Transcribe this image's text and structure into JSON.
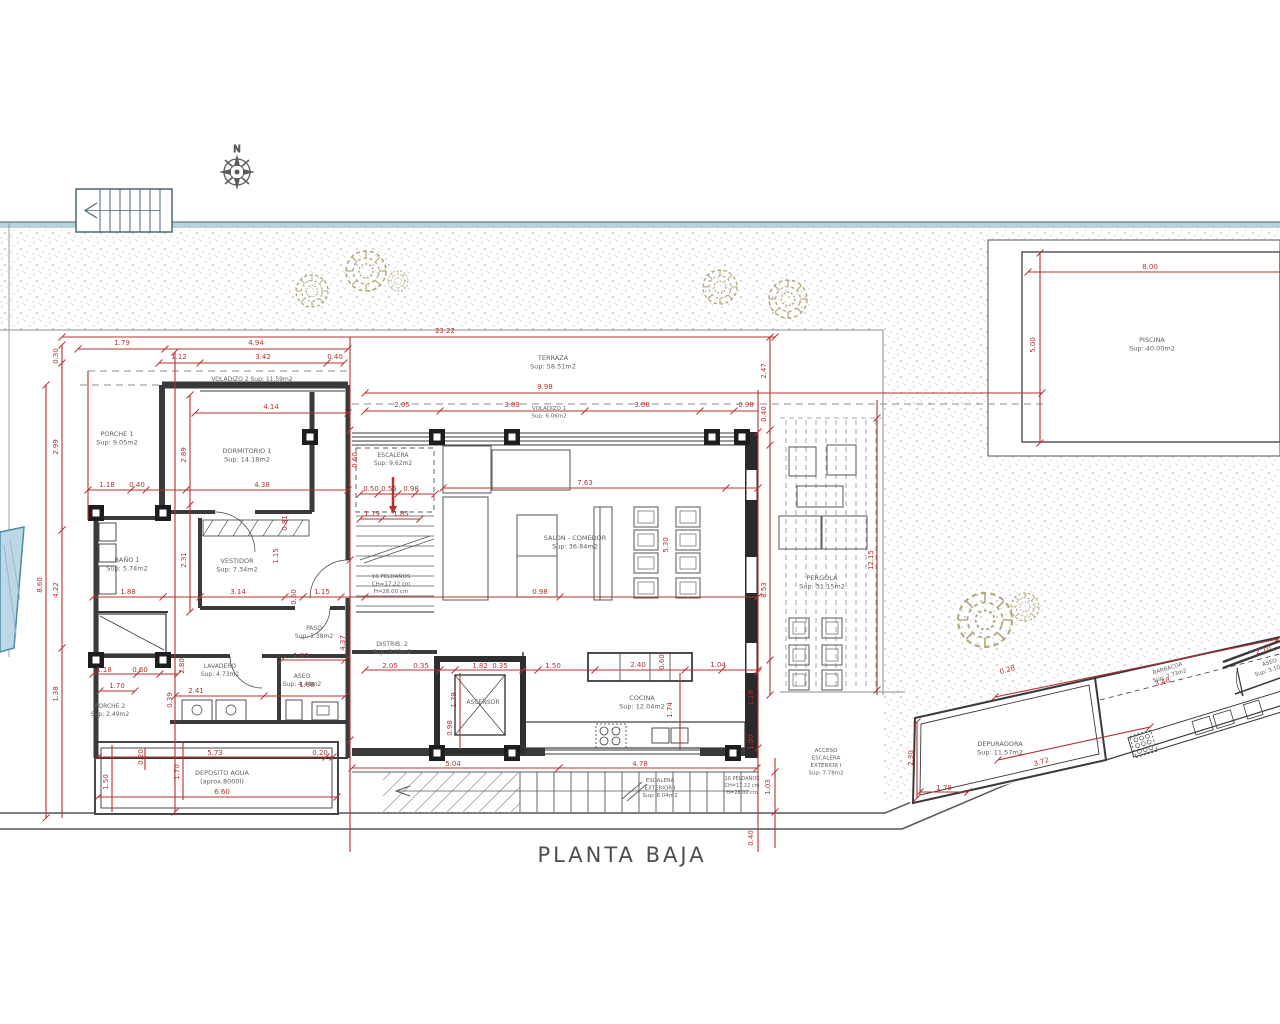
{
  "title": "PLANTA BAJA",
  "compass": "N",
  "colors": {
    "dimension_red": "#b5312f",
    "wall_dark": "#3a3a3c",
    "thin_line": "#6f7377",
    "stipple_gray": "#8e959b",
    "tree_tan": "#b3a87c",
    "water_blue": "#bcd8e6",
    "band_teal": "#b7d2da",
    "label_gray": "#5f5f5f"
  },
  "labels": [
    {
      "lines": [
        "PORCHE 1",
        "Sup: 9.05m2"
      ],
      "x": 117,
      "y": 436,
      "fs": 6.5
    },
    {
      "lines": [
        "VOLADIZO 2  Sup: 11.59m2"
      ],
      "x": 252,
      "y": 381,
      "fs": 6
    },
    {
      "lines": [
        "DORMITORIO 1",
        "Sup: 14.18m2"
      ],
      "x": 247,
      "y": 453,
      "fs": 6.5
    },
    {
      "lines": [
        "BAÑO 1",
        "Sup: 5.74m2"
      ],
      "x": 127,
      "y": 562,
      "fs": 6.5
    },
    {
      "lines": [
        "VESTIDOR",
        "Sup: 7.34m2"
      ],
      "x": 237,
      "y": 563,
      "fs": 6.5
    },
    {
      "lines": [
        "PASO",
        "Sup: 1.38m2"
      ],
      "x": 314,
      "y": 630,
      "fs": 6
    },
    {
      "lines": [
        "LAVADERO",
        "Sup: 4.73m2"
      ],
      "x": 220,
      "y": 668,
      "fs": 6
    },
    {
      "lines": [
        "ASEO",
        "Sup: 4.44m2"
      ],
      "x": 302,
      "y": 678,
      "fs": 6
    },
    {
      "lines": [
        "PORCHE 2",
        "Sup: 2.49m2"
      ],
      "x": 110,
      "y": 708,
      "fs": 6
    },
    {
      "lines": [
        "ESCALERA",
        "Sup: 9.62m2"
      ],
      "x": 393,
      "y": 457,
      "fs": 6
    },
    {
      "lines": [
        "DISTRIB. 2",
        "Sup: 3.13m2"
      ],
      "x": 392,
      "y": 646,
      "fs": 6
    },
    {
      "lines": [
        "ASCENSOR"
      ],
      "x": 483,
      "y": 704,
      "fs": 6
    },
    {
      "lines": [
        "SALON - COMEDOR",
        "Sup: 36.84m2"
      ],
      "x": 575,
      "y": 540,
      "fs": 6.5
    },
    {
      "lines": [
        "COCINA",
        "Sup: 12.04m2"
      ],
      "x": 642,
      "y": 700,
      "fs": 6.5
    },
    {
      "lines": [
        "TERRAZA",
        "Sup: 58.51m2"
      ],
      "x": 553,
      "y": 360,
      "fs": 6.5
    },
    {
      "lines": [
        "VOLADIZO 1",
        "Sup: 6.06m2"
      ],
      "x": 549,
      "y": 410,
      "fs": 5.5
    },
    {
      "lines": [
        "PERGOLA",
        "Sup: 31.15m2"
      ],
      "x": 822,
      "y": 580,
      "fs": 6.5
    },
    {
      "lines": [
        "PISCINA",
        "Sup: 40.00m2"
      ],
      "x": 1152,
      "y": 342,
      "fs": 6.5
    },
    {
      "lines": [
        "DEPOSITO AGUA",
        "(aprox.8000l)"
      ],
      "x": 222,
      "y": 775,
      "fs": 6.5
    },
    {
      "lines": [
        "ESCALERA",
        "EXTERIOR I",
        "Sup: 8.04m2"
      ],
      "x": 660,
      "y": 782,
      "fs": 5.5
    },
    {
      "lines": [
        "16 PELDAÑOS",
        "CH=17.22 cm",
        "H=28.00 cm"
      ],
      "x": 391,
      "y": 578,
      "fs": 5.5
    },
    {
      "lines": [
        "16 PELDAÑOS",
        "CH=17.22 cm",
        "H=28.00 cm"
      ],
      "x": 742,
      "y": 780,
      "fs": 5
    },
    {
      "lines": [
        "ACCESO",
        "ESCALERA",
        "EXTERIOR I",
        "Sup: 7.78m2"
      ],
      "x": 826,
      "y": 752,
      "fs": 5.5
    },
    {
      "lines": [
        "DEPURADORA",
        "Sup: 11.57m2"
      ],
      "x": 1000,
      "y": 746,
      "fs": 6.5
    },
    {
      "lines": [
        "BARBACOA",
        "Sup: 7.73m2"
      ],
      "x": 1168,
      "y": 670,
      "fs": 5.5,
      "r": -17
    },
    {
      "lines": [
        "ASEO",
        "Sup: 3.10m2"
      ],
      "x": 1270,
      "y": 664,
      "fs": 5.5,
      "r": -17
    }
  ],
  "dims": [
    {
      "t": "23.22",
      "x": 445,
      "y": 333
    },
    {
      "t": "1.79",
      "x": 122,
      "y": 345
    },
    {
      "t": "4.94",
      "x": 256,
      "y": 345
    },
    {
      "t": "1.12",
      "x": 179,
      "y": 359
    },
    {
      "t": "3.42",
      "x": 263,
      "y": 359
    },
    {
      "t": "0.40",
      "x": 335,
      "y": 359
    },
    {
      "t": "4.14",
      "x": 271,
      "y": 409
    },
    {
      "t": "9.98",
      "x": 545,
      "y": 389
    },
    {
      "t": "2.05",
      "x": 402,
      "y": 407
    },
    {
      "t": "3.89",
      "x": 512,
      "y": 407
    },
    {
      "t": "3.08",
      "x": 642,
      "y": 407
    },
    {
      "t": "0.98",
      "x": 746,
      "y": 407
    },
    {
      "t": "7.63",
      "x": 585,
      "y": 485
    },
    {
      "t": "5.30",
      "x": 668,
      "y": 545,
      "r": -90
    },
    {
      "t": "0.98",
      "x": 540,
      "y": 594
    },
    {
      "t": "2.47",
      "x": 766,
      "y": 371,
      "r": -90
    },
    {
      "t": "0.40",
      "x": 766,
      "y": 414,
      "r": -90
    },
    {
      "t": "8.53",
      "x": 766,
      "y": 590,
      "r": -90
    },
    {
      "t": "12.15",
      "x": 873,
      "y": 560,
      "r": -90
    },
    {
      "t": "0.30",
      "x": 58,
      "y": 356,
      "r": -90
    },
    {
      "t": "2.99",
      "x": 58,
      "y": 447,
      "r": -90
    },
    {
      "t": "4.22",
      "x": 58,
      "y": 590,
      "r": -90
    },
    {
      "t": "8.60",
      "x": 42,
      "y": 585,
      "r": -90
    },
    {
      "t": "2.89",
      "x": 186,
      "y": 455,
      "r": -90
    },
    {
      "t": "2.31",
      "x": 186,
      "y": 560,
      "r": -90
    },
    {
      "t": "1.18",
      "x": 107,
      "y": 487
    },
    {
      "t": "0.40",
      "x": 137,
      "y": 487
    },
    {
      "t": "4.38",
      "x": 262,
      "y": 487
    },
    {
      "t": "0.81",
      "x": 287,
      "y": 523,
      "r": -90
    },
    {
      "t": "1.15",
      "x": 278,
      "y": 556,
      "r": -90
    },
    {
      "t": "3.14",
      "x": 238,
      "y": 594
    },
    {
      "t": "1.88",
      "x": 128,
      "y": 594
    },
    {
      "t": "0.60",
      "x": 296,
      "y": 597,
      "r": -90
    },
    {
      "t": "1.15",
      "x": 322,
      "y": 594
    },
    {
      "t": "0.60",
      "x": 357,
      "y": 460,
      "r": -90
    },
    {
      "t": "0.50",
      "x": 371,
      "y": 491
    },
    {
      "t": "0.55",
      "x": 389,
      "y": 491
    },
    {
      "t": "0.98",
      "x": 411,
      "y": 491
    },
    {
      "t": "1.19",
      "x": 372,
      "y": 516
    },
    {
      "t": "1.85",
      "x": 401,
      "y": 516
    },
    {
      "t": "4.37",
      "x": 345,
      "y": 643,
      "r": -90
    },
    {
      "t": "1.83",
      "x": 301,
      "y": 658
    },
    {
      "t": "2.41",
      "x": 196,
      "y": 693
    },
    {
      "t": "1.88",
      "x": 307,
      "y": 687
    },
    {
      "t": "1.18",
      "x": 104,
      "y": 672
    },
    {
      "t": "0.60",
      "x": 140,
      "y": 672
    },
    {
      "t": "1.70",
      "x": 117,
      "y": 688
    },
    {
      "t": "1.38",
      "x": 58,
      "y": 694,
      "r": -90
    },
    {
      "t": "2.80",
      "x": 184,
      "y": 666,
      "r": -90
    },
    {
      "t": "0.39",
      "x": 172,
      "y": 700,
      "r": -90
    },
    {
      "t": "2.05",
      "x": 390,
      "y": 668
    },
    {
      "t": "0.35",
      "x": 421,
      "y": 668
    },
    {
      "t": "1.82",
      "x": 480,
      "y": 668
    },
    {
      "t": "0.35",
      "x": 500,
      "y": 668
    },
    {
      "t": "1.50",
      "x": 553,
      "y": 668
    },
    {
      "t": "2.40",
      "x": 638,
      "y": 667
    },
    {
      "t": "1.04",
      "x": 718,
      "y": 667
    },
    {
      "t": "0.60",
      "x": 664,
      "y": 662,
      "r": -90
    },
    {
      "t": "1.79",
      "x": 456,
      "y": 700,
      "r": -90
    },
    {
      "t": "1.74",
      "x": 672,
      "y": 710,
      "r": -90
    },
    {
      "t": "0.98",
      "x": 452,
      "y": 728,
      "r": -90
    },
    {
      "t": "1.19",
      "x": 753,
      "y": 698,
      "r": -90
    },
    {
      "t": "1.00",
      "x": 753,
      "y": 742,
      "r": -90
    },
    {
      "t": "5.04",
      "x": 453,
      "y": 766
    },
    {
      "t": "4.78",
      "x": 640,
      "y": 766
    },
    {
      "t": "1.03",
      "x": 770,
      "y": 787,
      "r": -90
    },
    {
      "t": "0.40",
      "x": 753,
      "y": 838,
      "r": -90
    },
    {
      "t": "5.73",
      "x": 215,
      "y": 755
    },
    {
      "t": "0.20",
      "x": 320,
      "y": 755
    },
    {
      "t": "6.60",
      "x": 222,
      "y": 794
    },
    {
      "t": "1.50",
      "x": 108,
      "y": 782,
      "r": -90
    },
    {
      "t": "1.70",
      "x": 179,
      "y": 772,
      "r": -90
    },
    {
      "t": "0.20",
      "x": 143,
      "y": 757,
      "r": -90
    },
    {
      "t": "8.00",
      "x": 1150,
      "y": 269
    },
    {
      "t": "5.00",
      "x": 1035,
      "y": 345,
      "r": -90
    },
    {
      "t": "2.30",
      "x": 913,
      "y": 758,
      "r": -90
    },
    {
      "t": "3.72",
      "x": 1042,
      "y": 764,
      "r": -17
    },
    {
      "t": "1.78",
      "x": 944,
      "y": 790
    },
    {
      "t": "3.48",
      "x": 1163,
      "y": 684,
      "r": -17
    },
    {
      "t": "2.10",
      "x": 1264,
      "y": 652,
      "r": -17
    },
    {
      "t": "0.28",
      "x": 1008,
      "y": 672,
      "r": -17
    }
  ],
  "dim_lines": {
    "h": [
      [
        337,
        62,
        775,
        [
          62,
          775
        ]
      ],
      [
        349,
        78,
        348,
        [
          78,
          165,
          348
        ]
      ],
      [
        363,
        159,
        344,
        [
          159,
          200,
          327,
          344
        ]
      ],
      [
        413,
        195,
        348,
        [
          195,
          348
        ]
      ],
      [
        393,
        365,
        1042,
        [
          365,
          1042
        ]
      ],
      [
        411,
        365,
        758,
        [
          365,
          440,
          585,
          700,
          734
        ]
      ],
      [
        488,
        443,
        758,
        [
          443,
          726,
          758
        ]
      ],
      [
        490,
        88,
        348,
        [
          88,
          131,
          146,
          186,
          348
        ]
      ],
      [
        597,
        93,
        758,
        [
          93,
          163,
          200,
          285,
          303,
          341,
          365,
          560,
          758
        ]
      ],
      [
        519,
        360,
        420,
        [
          360,
          382,
          420
        ]
      ],
      [
        494,
        360,
        435,
        [
          360,
          378,
          398,
          415,
          435
        ]
      ],
      [
        660,
        282,
        345,
        [
          282,
          345
        ]
      ],
      [
        674,
        93,
        178,
        [
          93,
          137,
          160,
          178
        ]
      ],
      [
        670,
        365,
        758,
        [
          365,
          440,
          455,
          523,
          538,
          595,
          685,
          722,
          758
        ]
      ],
      [
        691,
        100,
        135,
        [
          100,
          135
        ]
      ],
      [
        696,
        175,
        345,
        [
          175,
          264,
          345
        ]
      ],
      [
        768,
        352,
        757,
        [
          352,
          559,
          757
        ]
      ],
      [
        757,
        98,
        333,
        [
          98,
          326,
          333
        ]
      ],
      [
        797,
        98,
        337,
        [
          98,
          337
        ]
      ],
      [
        272,
        1028,
        1280,
        [
          1028
        ]
      ],
      [
        792,
        920,
        968,
        [
          920,
          968
        ]
      ]
    ],
    "v": [
      [
        62,
        345,
        818,
        [
          345,
          363,
          530,
          648
        ]
      ],
      [
        46,
        385,
        818,
        [
          385,
          818
        ]
      ],
      [
        88,
        371,
        520,
        []
      ],
      [
        175,
        352,
        812,
        [
          352,
          812
        ]
      ],
      [
        190,
        395,
        612,
        [
          395,
          505,
          612
        ]
      ],
      [
        350,
        337,
        852,
        [
          430,
          560,
          740
        ]
      ],
      [
        758,
        390,
        852,
        [
          432,
          672,
          748
        ]
      ],
      [
        770,
        337,
        695,
        [
          337,
          430,
          445,
          660,
          695
        ]
      ],
      [
        877,
        400,
        695,
        [
          418,
          690
        ]
      ],
      [
        775,
        758,
        848,
        [
          772,
          812
        ]
      ],
      [
        1040,
        253,
        443,
        [
          253,
          443
        ]
      ],
      [
        112,
        745,
        812,
        []
      ],
      [
        183,
        743,
        800,
        []
      ],
      [
        917,
        722,
        798,
        [
          722,
          798
        ]
      ],
      [
        680,
        673,
        750,
        []
      ],
      [
        460,
        673,
        750,
        []
      ],
      [
        145,
        748,
        770,
        []
      ]
    ],
    "s": [
      [
        995,
        697,
        1278,
        639
      ],
      [
        998,
        760,
        1150,
        727
      ]
    ]
  },
  "trees": [
    {
      "x": 312,
      "y": 291,
      "s": 0.8
    },
    {
      "x": 366,
      "y": 271,
      "s": 1.0
    },
    {
      "x": 398,
      "y": 281,
      "s": 0.5
    },
    {
      "x": 720,
      "y": 287,
      "s": 0.85
    },
    {
      "x": 788,
      "y": 299,
      "s": 0.95
    },
    {
      "x": 985,
      "y": 620,
      "s": 1.35
    },
    {
      "x": 1025,
      "y": 607,
      "s": 0.7
    }
  ]
}
